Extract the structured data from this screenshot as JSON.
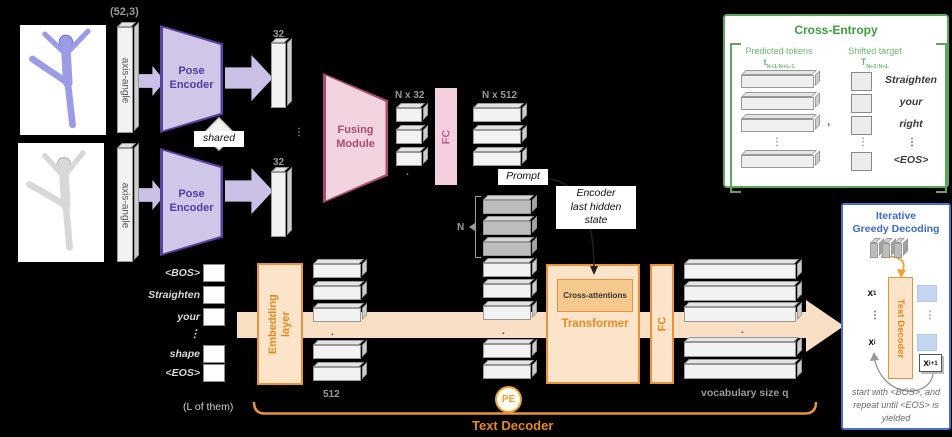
{
  "pose_branch": {
    "input_shape": "(52,3)",
    "axis_angle": "axis-angle",
    "encoder_line1": "Pose",
    "encoder_line2": "Encoder",
    "shared": "shared",
    "dim": "32"
  },
  "fusing": {
    "module_line1": "Fusing",
    "module_line2": "Module",
    "tokens": "N x 32",
    "fc": "FC",
    "projected": "N x 512",
    "prompt": "Prompt"
  },
  "decoder": {
    "words": [
      "<BOS>",
      "Straighten",
      "your",
      "⋮",
      "shape",
      "<EOS>"
    ],
    "embedding_line1": "Embedding",
    "embedding_line2": "layer",
    "dim": "512",
    "n": "N",
    "encoder_state_lines": [
      "Encoder",
      "last hidden",
      "state"
    ],
    "cross_attentions": "Cross-attentions",
    "transformer": "Transformer",
    "fc": "FC",
    "vocab": "vocabulary size q",
    "pe": "PE",
    "count_note": "(L of them)",
    "title": "Text Decoder"
  },
  "cross_entropy": {
    "title": "Cross-Entropy",
    "predicted_label": "Predicted tokens",
    "predicted_token": {
      "base": "t",
      "sub": "N+1:N+L-1"
    },
    "shifted_label": "Shifted target",
    "shifted_token": {
      "base": "T",
      "sub": "N+2:N+L"
    },
    "comma": ",",
    "target_words": [
      "Straighten",
      "your",
      "right",
      "⋮",
      "<EOS>"
    ]
  },
  "greedy": {
    "title_lines": [
      "Iterative",
      "Greedy Decoding"
    ],
    "decoder_box": "Text Decoder",
    "x_first": {
      "base": "x",
      "sub": "1"
    },
    "x_i": {
      "base": "x",
      "sub": "i"
    },
    "x_next": {
      "base": "x",
      "sub": "i+1"
    },
    "note_lines": [
      "start with <BOS>, and",
      "repeat until <EOS> is",
      "yielded"
    ]
  },
  "misc": {
    "vdots": "⋮",
    "dot": "."
  },
  "colors": {
    "orange_accent": "#E8891F",
    "orange_border": "#E8923A",
    "purple_text": "#4F3D9E",
    "pink_text": "#A84C72",
    "green_accent": "#3C9E3C",
    "blue_accent": "#3B6BC7"
  }
}
